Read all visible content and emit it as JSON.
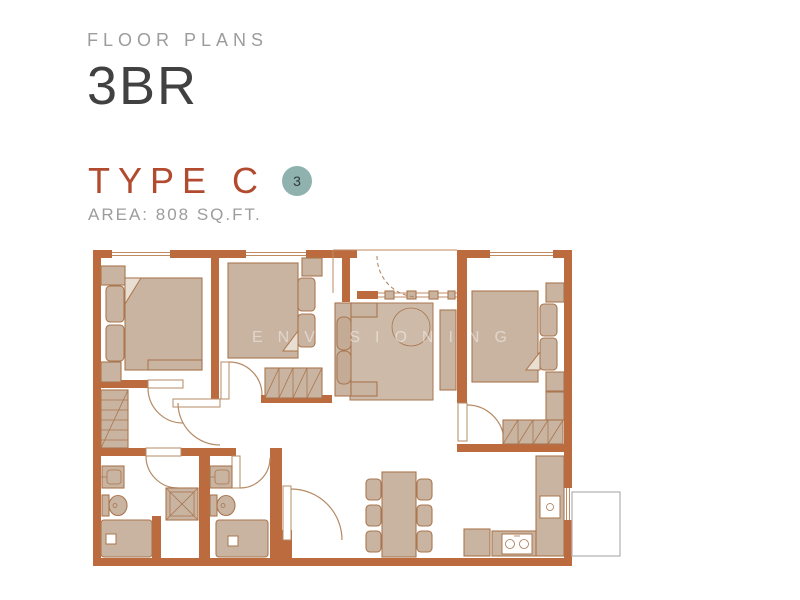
{
  "header": {
    "eyebrow": "FLOOR PLANS",
    "title": "3BR"
  },
  "plan_info": {
    "type_label": "TYPE C",
    "badge": "3",
    "area": "AREA: 808 SQ.FT."
  },
  "watermark": "ENVISIONING",
  "colors": {
    "wall": "#bb6b3e",
    "furniture": "#c9b4a1",
    "rug": "#cdbaa8",
    "furniture_stroke": "#a9764f",
    "thin_line": "#c08a62",
    "door_line": "#b58a65",
    "accent": "#b14a2f",
    "badge": "#8fb2ae",
    "badge_text": "#2f3a3a",
    "title_dark": "#414141",
    "muted": "#9c9c9c",
    "fold": "#e9ded2",
    "ledge_stroke": "#b0b0b0"
  }
}
